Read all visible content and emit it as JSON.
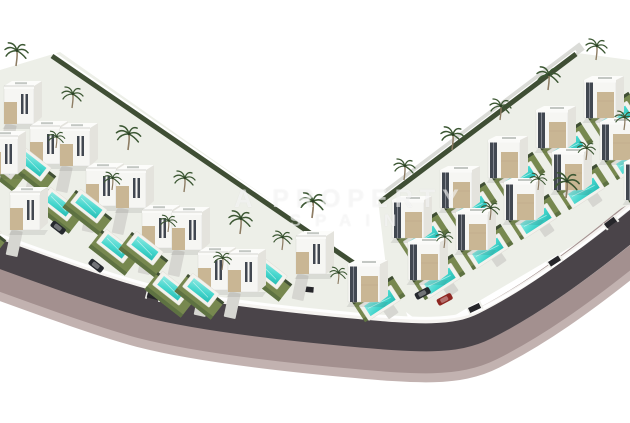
{
  "scene": {
    "description": "Aerial 3D architectural rendering of a modern villa development: two diagonal rows of white cube villas with beige stone accents, private turquoise pools, lawns and palm trees, wrapped by a curved asphalt road with a mauve sidewalk on white background",
    "background": "#ffffff"
  },
  "watermark": {
    "line1": "A PROPERTY",
    "line2": "SPAIN"
  },
  "palette": {
    "asphalt": "#4a4449",
    "sidewalk": "#a3908f",
    "sidewalk_outer": "#c2b2b0",
    "curb": "#f5f3f0",
    "plot_base": "#edefe8",
    "lawn": "#77884f",
    "lawn_dark": "#5e7242",
    "hedge": "#3f4e34",
    "pool_light": "#8fe9e2",
    "pool_mid": "#45d6cd",
    "pool_dark": "#27bcb4",
    "deck": "#f3f2ed",
    "house_white": "#f6f6f3",
    "house_side": "#e4e3dd",
    "house_top": "#fcfcfa",
    "beige": "#c9b694",
    "glazing": "#414750",
    "palm_frond": "#3c5733",
    "palm_trunk": "#8d7c63",
    "car_red": "#8e2722",
    "car_dark": "#26292e",
    "drive": "#d6d6d1",
    "gate": "#26262a",
    "wall_white": "#ffffff"
  },
  "road": {
    "path": "M -6 252 C 60 276, 105 292, 145 303 C 200 317, 280 326, 345 332 C 420 339, 455 341, 485 326 C 525 306, 570 276, 636 222",
    "asphalt_width": 28,
    "curb_width": 33,
    "sidewalk_width": 54,
    "sidewalk_outer_width": 62
  },
  "plots": {
    "left_outline": "0,70 60,52 398,290 414,334 240,322 0,236",
    "right_outline": "630,60 570,52 378,200 390,300 430,330 630,212",
    "left_back_wall": {
      "x1": 52,
      "y1": 56,
      "x2": 396,
      "y2": 292
    },
    "right_back_wall": {
      "x1": 576,
      "y1": 54,
      "x2": 380,
      "y2": 202
    }
  },
  "villas": [
    {
      "x": 4,
      "y": 80,
      "style": "left"
    },
    {
      "x": 60,
      "y": 122,
      "style": "left"
    },
    {
      "x": 116,
      "y": 164,
      "style": "left"
    },
    {
      "x": 172,
      "y": 206,
      "style": "left"
    },
    {
      "x": 228,
      "y": 248,
      "style": "left"
    },
    {
      "x": -12,
      "y": 130,
      "style": "left"
    },
    {
      "x": 30,
      "y": 120,
      "style": "left"
    },
    {
      "x": 86,
      "y": 162,
      "style": "left"
    },
    {
      "x": 142,
      "y": 204,
      "style": "left"
    },
    {
      "x": 198,
      "y": 246,
      "style": "left"
    },
    {
      "x": 10,
      "y": 186,
      "style": "left"
    },
    {
      "x": 296,
      "y": 230,
      "style": "left"
    },
    {
      "x": 348,
      "y": 258,
      "style": "right"
    },
    {
      "x": 584,
      "y": 74,
      "style": "right"
    },
    {
      "x": 536,
      "y": 104,
      "style": "right"
    },
    {
      "x": 488,
      "y": 134,
      "style": "right"
    },
    {
      "x": 440,
      "y": 164,
      "style": "right"
    },
    {
      "x": 392,
      "y": 194,
      "style": "right"
    },
    {
      "x": 600,
      "y": 116,
      "style": "right"
    },
    {
      "x": 552,
      "y": 146,
      "style": "right"
    },
    {
      "x": 504,
      "y": 176,
      "style": "right"
    },
    {
      "x": 456,
      "y": 206,
      "style": "right"
    },
    {
      "x": 408,
      "y": 236,
      "style": "right"
    },
    {
      "x": 624,
      "y": 156,
      "style": "right"
    }
  ],
  "palms": [
    {
      "x": 16,
      "y": 66,
      "s": 1.1
    },
    {
      "x": 72,
      "y": 108,
      "s": 1.0
    },
    {
      "x": 128,
      "y": 150,
      "s": 1.15
    },
    {
      "x": 184,
      "y": 192,
      "s": 1.0
    },
    {
      "x": 240,
      "y": 234,
      "s": 1.1
    },
    {
      "x": 56,
      "y": 148,
      "s": 0.8
    },
    {
      "x": 112,
      "y": 190,
      "s": 0.85
    },
    {
      "x": 168,
      "y": 232,
      "s": 0.8
    },
    {
      "x": 222,
      "y": 270,
      "s": 0.85
    },
    {
      "x": 282,
      "y": 250,
      "s": 0.9
    },
    {
      "x": 312,
      "y": 218,
      "s": 1.2
    },
    {
      "x": 338,
      "y": 284,
      "s": 0.8
    },
    {
      "x": 596,
      "y": 60,
      "s": 1.0
    },
    {
      "x": 548,
      "y": 90,
      "s": 1.1
    },
    {
      "x": 500,
      "y": 120,
      "s": 1.0
    },
    {
      "x": 452,
      "y": 150,
      "s": 1.1
    },
    {
      "x": 404,
      "y": 180,
      "s": 1.0
    },
    {
      "x": 586,
      "y": 160,
      "s": 0.85
    },
    {
      "x": 538,
      "y": 190,
      "s": 0.8
    },
    {
      "x": 490,
      "y": 220,
      "s": 0.85
    },
    {
      "x": 444,
      "y": 248,
      "s": 0.8
    },
    {
      "x": 566,
      "y": 198,
      "s": 1.2
    },
    {
      "x": 624,
      "y": 130,
      "s": 0.9
    }
  ],
  "cars": [
    {
      "x": 54,
      "y": 220,
      "rot": 38,
      "color": "dark"
    },
    {
      "x": 92,
      "y": 258,
      "rot": 38,
      "color": "dark"
    },
    {
      "x": 414,
      "y": 294,
      "rot": -28,
      "color": "dark"
    },
    {
      "x": 436,
      "y": 300,
      "rot": -28,
      "color": "red"
    }
  ],
  "gates": [
    {
      "x": 148,
      "y": 292,
      "rot": 14
    },
    {
      "x": 302,
      "y": 286,
      "rot": 6
    },
    {
      "x": 468,
      "y": 308,
      "rot": -25
    },
    {
      "x": 548,
      "y": 262,
      "rot": -33
    },
    {
      "x": 604,
      "y": 224,
      "rot": -37
    }
  ]
}
